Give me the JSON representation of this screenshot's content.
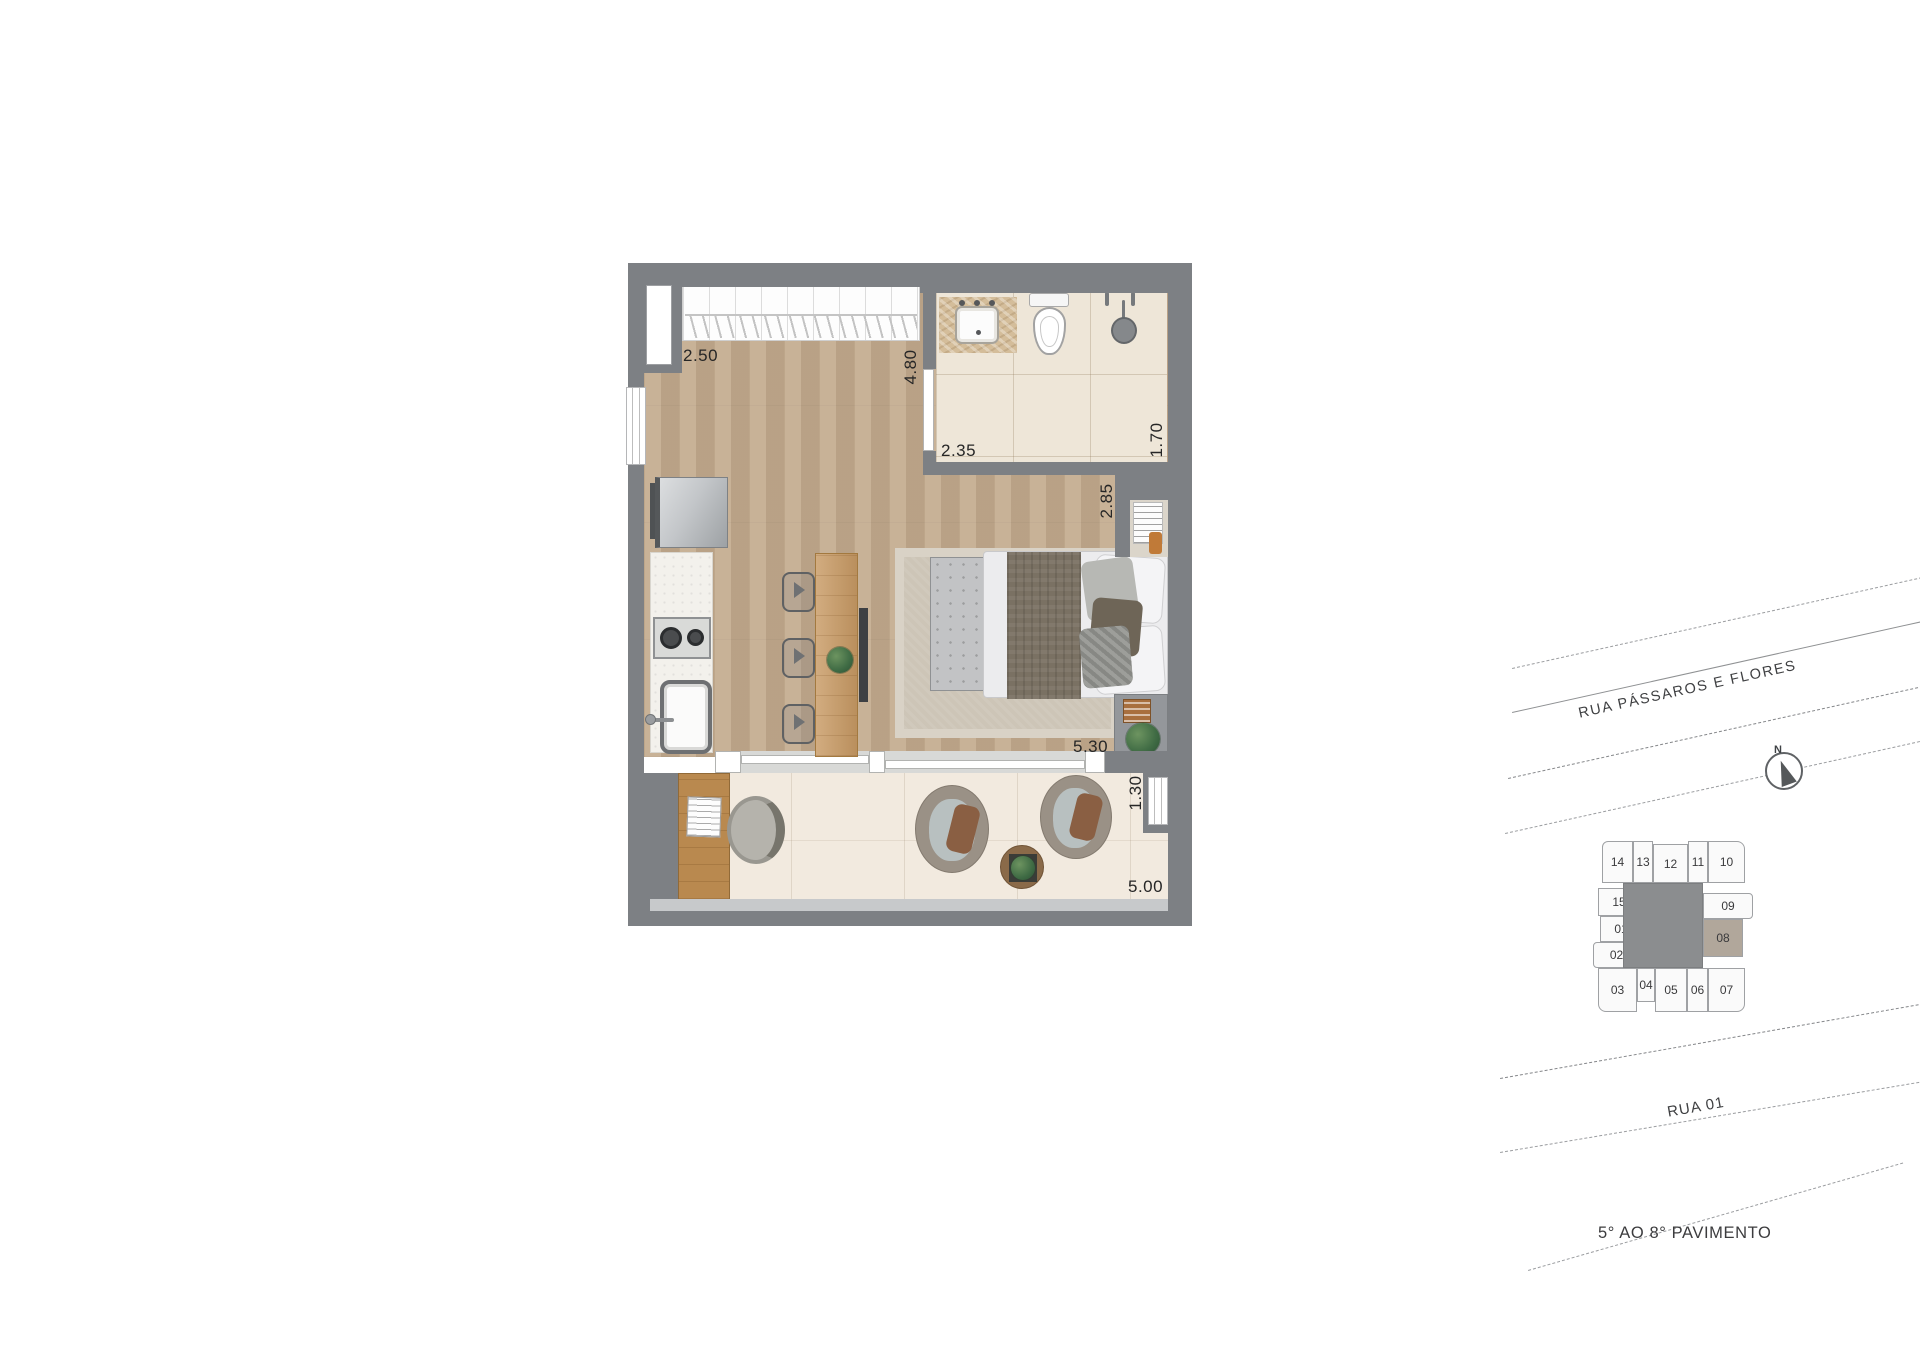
{
  "floor_plan": {
    "dims": {
      "closet_width": "2.50",
      "room_depth": "4.80",
      "bath_width": "2.35",
      "bath_depth": "1.70",
      "bed_width": "2.85",
      "room_width": "5.30",
      "balcony_depth": "1.30",
      "balcony_width": "5.00"
    }
  },
  "site_plan": {
    "street_top_label": "RUA PÁSSAROS E FLORES",
    "street_bottom_label": "RUA 01",
    "caption": "5° AO 8° PAVIMENTO",
    "compass_north": "N",
    "key_plan": {
      "highlighted_unit": "08",
      "units": [
        {
          "label": "14"
        },
        {
          "label": "13"
        },
        {
          "label": "12"
        },
        {
          "label": "11"
        },
        {
          "label": "10"
        },
        {
          "label": "15"
        },
        {
          "label": "01"
        },
        {
          "label": "02"
        },
        {
          "label": "09"
        },
        {
          "label": "08"
        },
        {
          "label": "03"
        },
        {
          "label": "04"
        },
        {
          "label": "05"
        },
        {
          "label": "06"
        },
        {
          "label": "07"
        }
      ]
    }
  },
  "colors": {
    "wall": "#7d8084",
    "wood": "#c3aa8d",
    "bath_floor": "#eee6d8",
    "balcony_floor": "#f2eadf",
    "rug": "#cdc5b7",
    "unit_fill": "#fafafa",
    "unit_border": "#9fa1a4",
    "keyplan_core": "#8b8d8f",
    "highlight_unit": "#b1a79b",
    "dim_text": "#262626"
  }
}
